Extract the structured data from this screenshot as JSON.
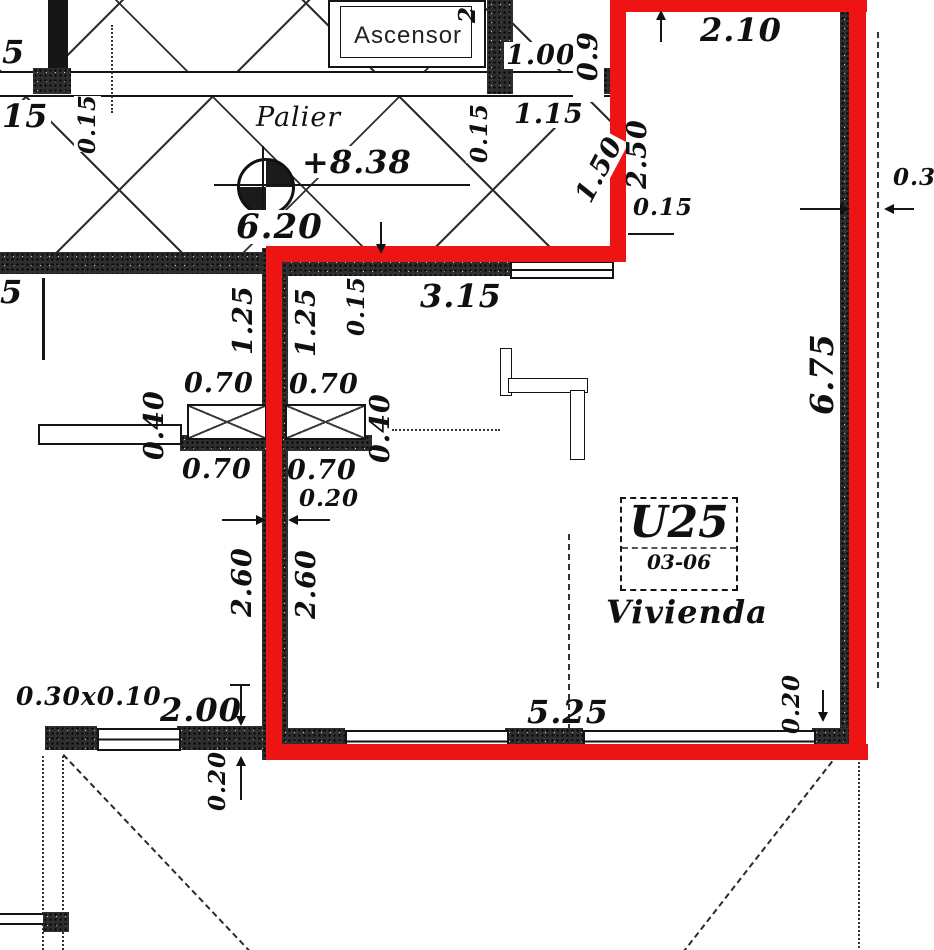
{
  "plan": {
    "unit_label": {
      "id": "U25",
      "floor": "03-06",
      "type": "Vivienda"
    },
    "rooms": {
      "palier": "Palier",
      "ascensor": "Ascensor"
    },
    "level_marker": {
      "value": "+8.38"
    },
    "colors": {
      "outline_red": "#ee1414",
      "ink": "#111111"
    },
    "dimensions": {
      "edge_top_5": "5",
      "edge_top_15": "15",
      "wall_015_left": "0.15",
      "elevator_2": "2",
      "d_100": "1.00",
      "d_09": "0.9",
      "d_115": "1.15",
      "wall_015_mid": "0.15",
      "d_150": "1.50",
      "d_620": "6.20",
      "d_210": "2.10",
      "d_250": "2.50",
      "wall_015_tr": "0.15",
      "d_03": "0.3",
      "d_675": "6.75",
      "d_315": "3.15",
      "d_125_left": "1.25",
      "d_125_right": "1.25",
      "wall_015_center": "0.15",
      "d_070_tl": "0.70",
      "d_070_tr": "0.70",
      "d_040_left": "0.40",
      "d_040_right": "0.40",
      "d_070_bl": "0.70",
      "d_070_br": "0.70",
      "wall_020_center": "0.20",
      "d_260_left": "2.60",
      "d_260_right": "2.60",
      "edge_mid_5": "5",
      "beam_030x010": "0.30x0.10",
      "d_200": "2.00",
      "wall_020_bl": "0.20",
      "d_525": "5.25",
      "wall_020_br": "0.20"
    }
  }
}
